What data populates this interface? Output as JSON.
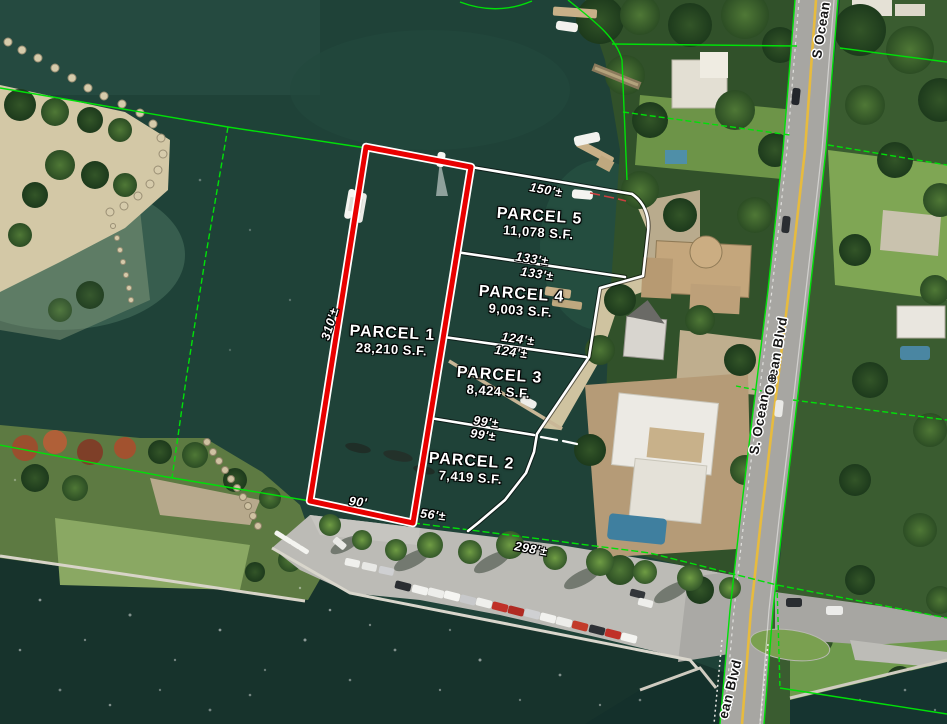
{
  "map_type": "aerial parcel survey",
  "parcels": [
    {
      "name": "PARCEL 1",
      "area_sf": "28,210 S.F."
    },
    {
      "name": "PARCEL 2",
      "area_sf": "7,419 S.F."
    },
    {
      "name": "PARCEL 3",
      "area_sf": "8,424 S.F."
    },
    {
      "name": "PARCEL 4",
      "area_sf": "9,003 S.F."
    },
    {
      "name": "PARCEL 5",
      "area_sf": "11,078 S.F."
    }
  ],
  "dimensions": {
    "parcel1_west": "310'±",
    "parcel1_south": "90'",
    "parcel5_north": "150'±",
    "divider_5_4_upper": "133'±",
    "divider_5_4_lower": "133'±",
    "divider_4_3_upper": "124'±",
    "divider_4_3_lower": "124'±",
    "divider_3_2_upper": "99'±",
    "divider_3_2_lower": "99'±",
    "south_boundary_west": "56'±",
    "south_boundary_east": "298'±"
  },
  "road_labels": {
    "top": "S Ocean",
    "mid_upper": "Ocean Blvd",
    "mid_lower": "S. Ocean",
    "bottom": "ean Blvd"
  },
  "symbols": {
    "benchmark": "⊕"
  },
  "colors": {
    "parcel1_outline": "#e80000",
    "survey_line": "#ffffff",
    "gis_boundary": "#00e008",
    "road_centerline": "#e7bb3e",
    "water": "#1f4238"
  }
}
